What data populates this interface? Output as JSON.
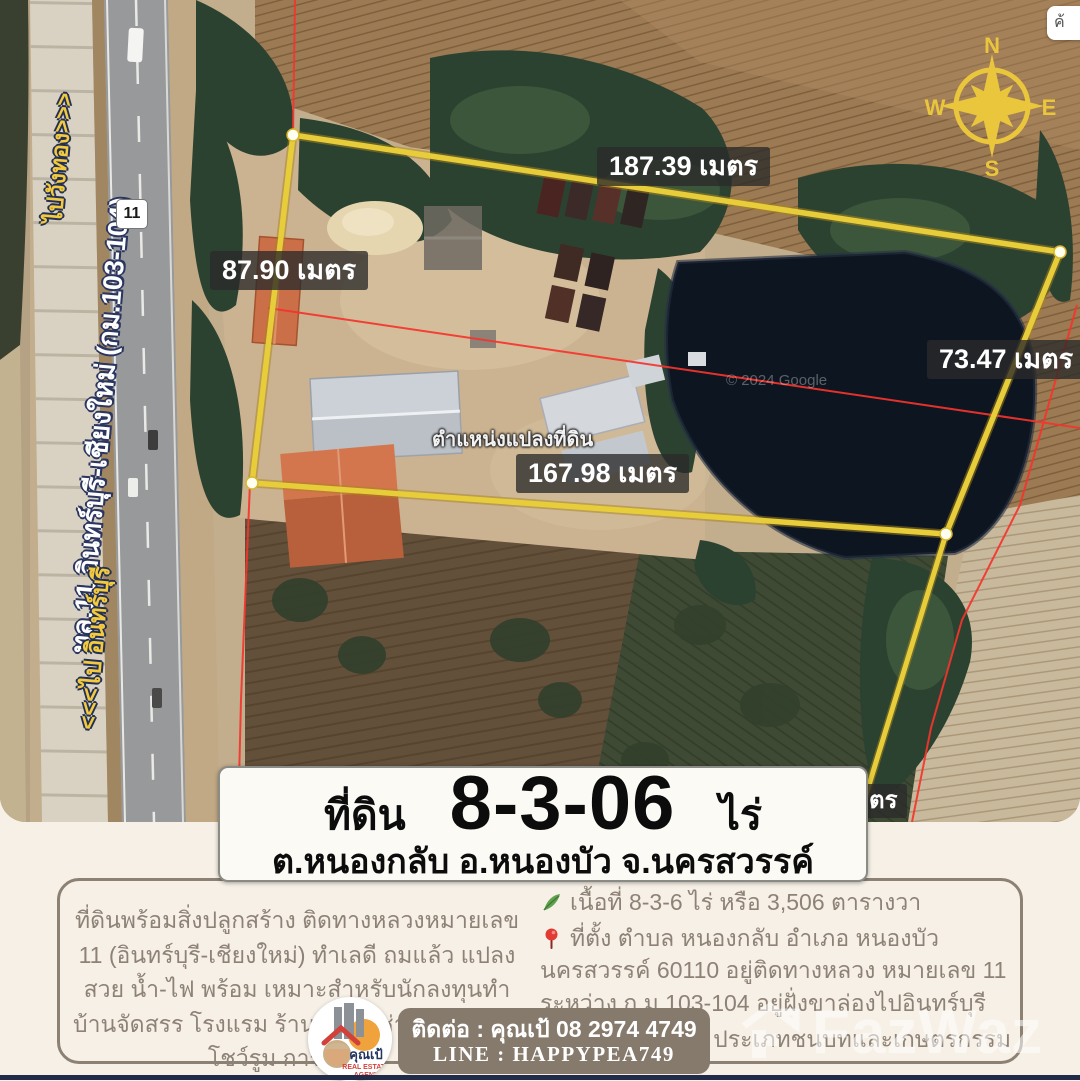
{
  "map": {
    "measurements": {
      "top": "187.39 เมตร",
      "left": "87.90 เมตร",
      "right": "73.47 เมตร",
      "bottom": "167.98 เมตร",
      "hidden_partial": "เมตร"
    },
    "road_labels": {
      "to_north": "ไปวังทอง>>>",
      "highway": "ทล.11 อินทร์บุรี-เชียงใหม่ (กม.103-104)",
      "to_south": "<<<ไป อินทร์บุรี"
    },
    "route_shield": "11",
    "parcel_caption": "ตำแหน่งแปลงที่ดิน",
    "credit": "© 2024 Google",
    "search_fragment": "ค้",
    "compass": {
      "n": "N",
      "e": "E",
      "s": "S",
      "w": "W"
    }
  },
  "title_box": {
    "prefix": "ที่ดิน",
    "area_rai": "8-3-06",
    "unit": "ไร่",
    "location": "ต.หนองกลับ อ.หนองบัว จ.นครสวรรค์"
  },
  "description": "ที่ดินพร้อมสิ่งปลูกสร้าง ติดทางหลวงหมายเลข 11 (อินทร์บุรี-เชียงใหม่) ทำเลดี ถมแล้ว แปลงสวย น้ำ-ไฟ พร้อม เหมาะสำหรับนักลงทุนทำบ้านจัดสรร โรงแรม ร้านค้าให้เช่า ร้านอาหาร โชว์รูม การเกษตร",
  "details": [
    {
      "icon": "leaf-icon",
      "text": "เนื้อที่ 8-3-6 ไร่ หรือ 3,506 ตารางวา"
    },
    {
      "icon": "pin-icon",
      "text": "ที่ตั้ง  ตำบล หนองกลับ อำเภอ หนองบัว นครสวรรค์ 60110 อยู่ติดทางหลวง หมายเลข 11 ระหว่าง ก.ม.103-104 อยู่ฝั่งขาล่องไปอินทร์บุรี"
    },
    {
      "icon": "yarn-icon",
      "text": "ผังเมืองสีเขียว ประเภทชนบทและเกษตรกรรม"
    }
  ],
  "agent": {
    "name": "คุณเป้",
    "tagline1": "REAL ESTATE",
    "tagline2": "AGENT",
    "contact": "ติดต่อ : คุณเป้  08 2974 4749",
    "line": "LINE : HAPPYPEA749"
  },
  "watermark": "FazWaz",
  "colors": {
    "parcel_outline": "#e8cd3a",
    "cadastral_line": "#f5342c",
    "compass_gold": "#eac63d",
    "panel_cream": "#f6f0e6",
    "contact_bar": "#867a6c",
    "text_brown": "#8e8277",
    "navy_strip": "#222b47"
  }
}
